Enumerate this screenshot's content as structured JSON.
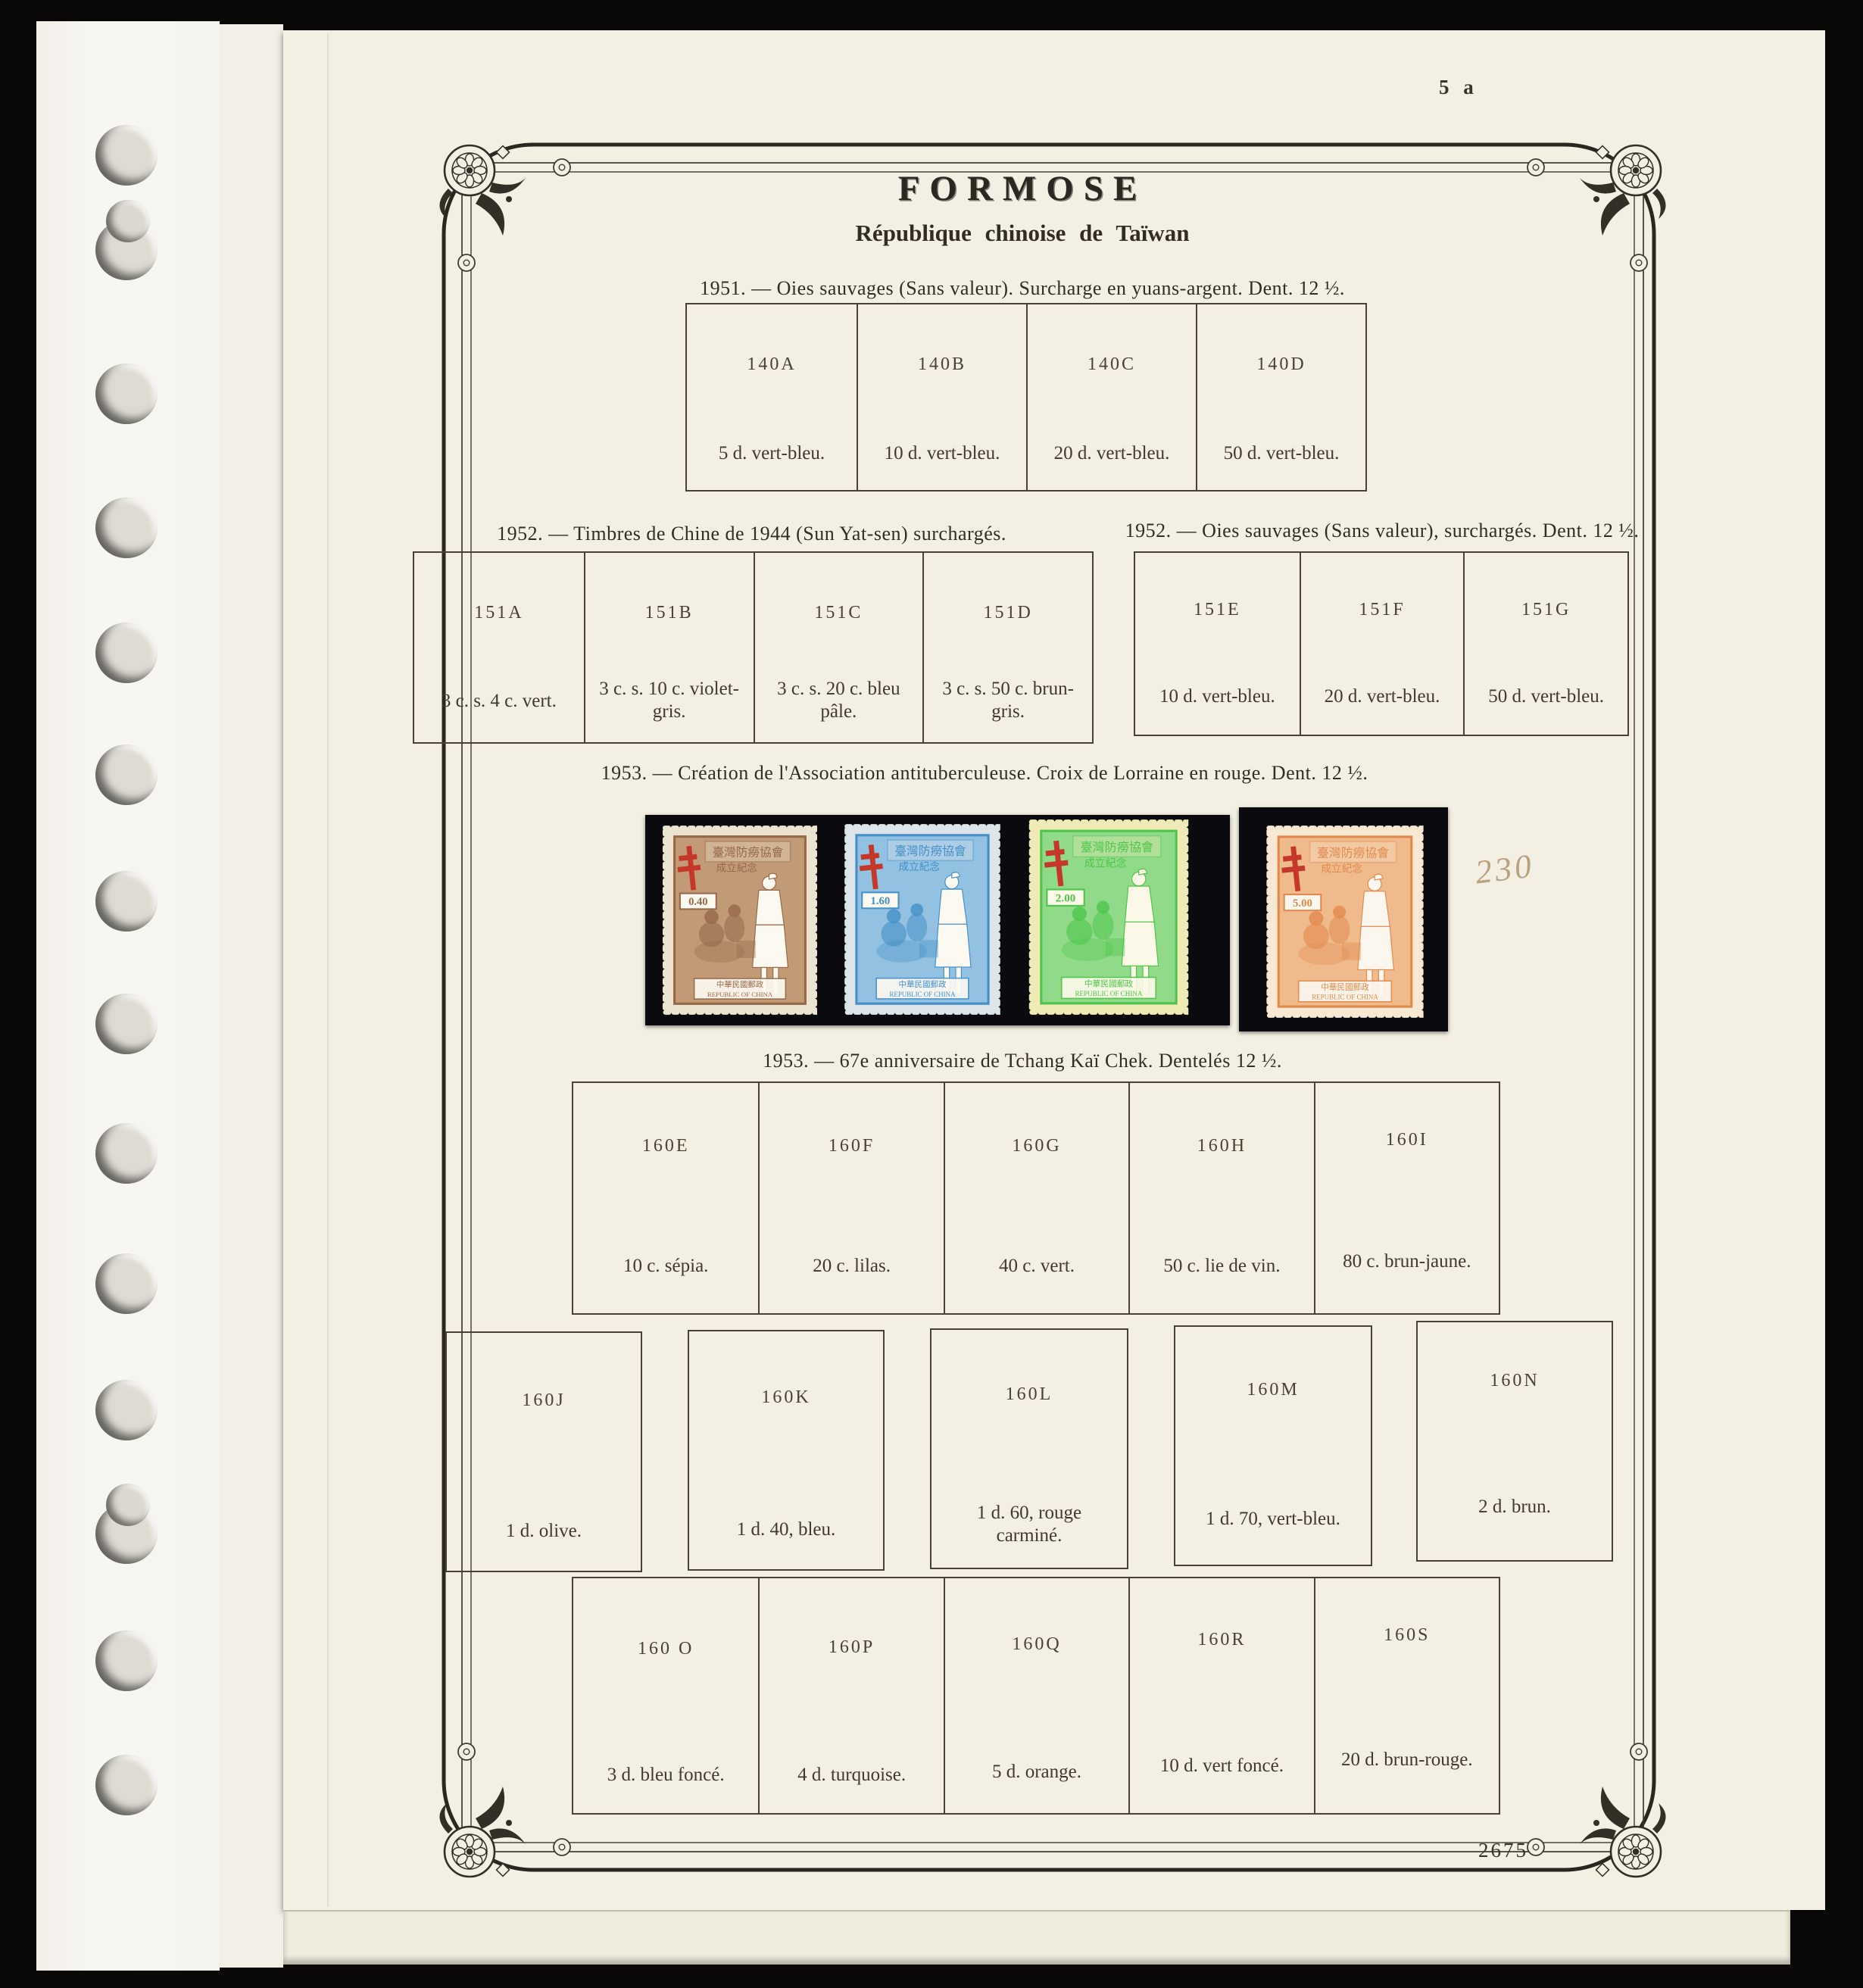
{
  "page": {
    "page_number": "5 a",
    "plate_number": "2675",
    "handwritten_note": "230",
    "title": "FORMOSE",
    "subtitle": "République chinoise de Taïwan"
  },
  "sections": {
    "s1951": {
      "header": "1951. — Oies sauvages (Sans valeur). Surcharge en yuans-argent. Dent. 12 ½.",
      "cells": [
        {
          "code": "140A",
          "caption": "5 d. vert-bleu."
        },
        {
          "code": "140B",
          "caption": "10 d. vert-bleu."
        },
        {
          "code": "140C",
          "caption": "20 d. vert-bleu."
        },
        {
          "code": "140D",
          "caption": "50 d. vert-bleu."
        }
      ]
    },
    "s1952_sunyatsen": {
      "header": "1952. — Timbres de Chine de 1944 (Sun Yat-sen) surchargés.",
      "cells": [
        {
          "code": "151A",
          "caption": "3 c. s. 4 c. vert."
        },
        {
          "code": "151B",
          "caption": "3 c. s. 10 c. violet-gris."
        },
        {
          "code": "151C",
          "caption": "3 c. s. 20 c. bleu pâle."
        },
        {
          "code": "151D",
          "caption": "3 c. s. 50 c. brun-gris."
        }
      ]
    },
    "s1952_oies": {
      "header": "1952. — Oies sauvages (Sans valeur), surchargés. Dent. 12 ½.",
      "cells": [
        {
          "code": "151E",
          "caption": "10 d. vert-bleu."
        },
        {
          "code": "151F",
          "caption": "20 d. vert-bleu."
        },
        {
          "code": "151G",
          "caption": "50 d. vert-bleu."
        }
      ]
    },
    "s1953_tb": {
      "header": "1953. — Création de l'Association antituberculeuse. Croix de Lorraine en rouge. Dent. 12 ½."
    },
    "s1953_chiang": {
      "header": "1953. — 67e anniversaire de Tchang Kaï Chek. Dentelés 12 ½.",
      "row1": [
        {
          "code": "160E",
          "caption": "10 c. sépia."
        },
        {
          "code": "160F",
          "caption": "20 c. lilas."
        },
        {
          "code": "160G",
          "caption": "40 c. vert."
        },
        {
          "code": "160H",
          "caption": "50 c. lie de vin."
        },
        {
          "code": "160I",
          "caption": "80 c. brun-jaune."
        }
      ],
      "row2": [
        {
          "code": "160J",
          "caption": "1 d. olive."
        },
        {
          "code": "160K",
          "caption": "1 d. 40, bleu."
        },
        {
          "code": "160L",
          "caption": "1 d. 60, rouge carminé."
        },
        {
          "code": "160M",
          "caption": "1 d. 70, vert-bleu."
        },
        {
          "code": "160N",
          "caption": "2 d. brun."
        }
      ],
      "row3": [
        {
          "code": "160 O",
          "caption": "3 d. bleu foncé."
        },
        {
          "code": "160P",
          "caption": "4 d. turquoise."
        },
        {
          "code": "160Q",
          "caption": "5 d. orange."
        },
        {
          "code": "160R",
          "caption": "10 d. vert foncé."
        },
        {
          "code": "160S",
          "caption": "20 d. brun-rouge."
        }
      ]
    }
  },
  "stamps": {
    "overprint_red": "#c5372a",
    "inscription_top": "臺灣防癆協會",
    "inscription_top2": "成立紀念",
    "inscription_bottom_cn": "中華民國郵政",
    "inscription_bottom_en": "REPUBLIC OF CHINA",
    "items": [
      {
        "value": "0.40",
        "color_name": "brun",
        "paper": "#ece3d0",
        "ink": "#96694a",
        "tint": "#c29b76"
      },
      {
        "value": "1.60",
        "color_name": "bleu",
        "paper": "#dde5ea",
        "ink": "#4590c8",
        "tint": "#92c1e2"
      },
      {
        "value": "2.00",
        "color_name": "vert",
        "paper": "#f0eab6",
        "ink": "#4fc64b",
        "tint": "#90da8a"
      },
      {
        "value": "5.00",
        "color_name": "orange",
        "paper": "#f6e8d2",
        "ink": "#e28a4e",
        "tint": "#efba8c"
      }
    ]
  }
}
